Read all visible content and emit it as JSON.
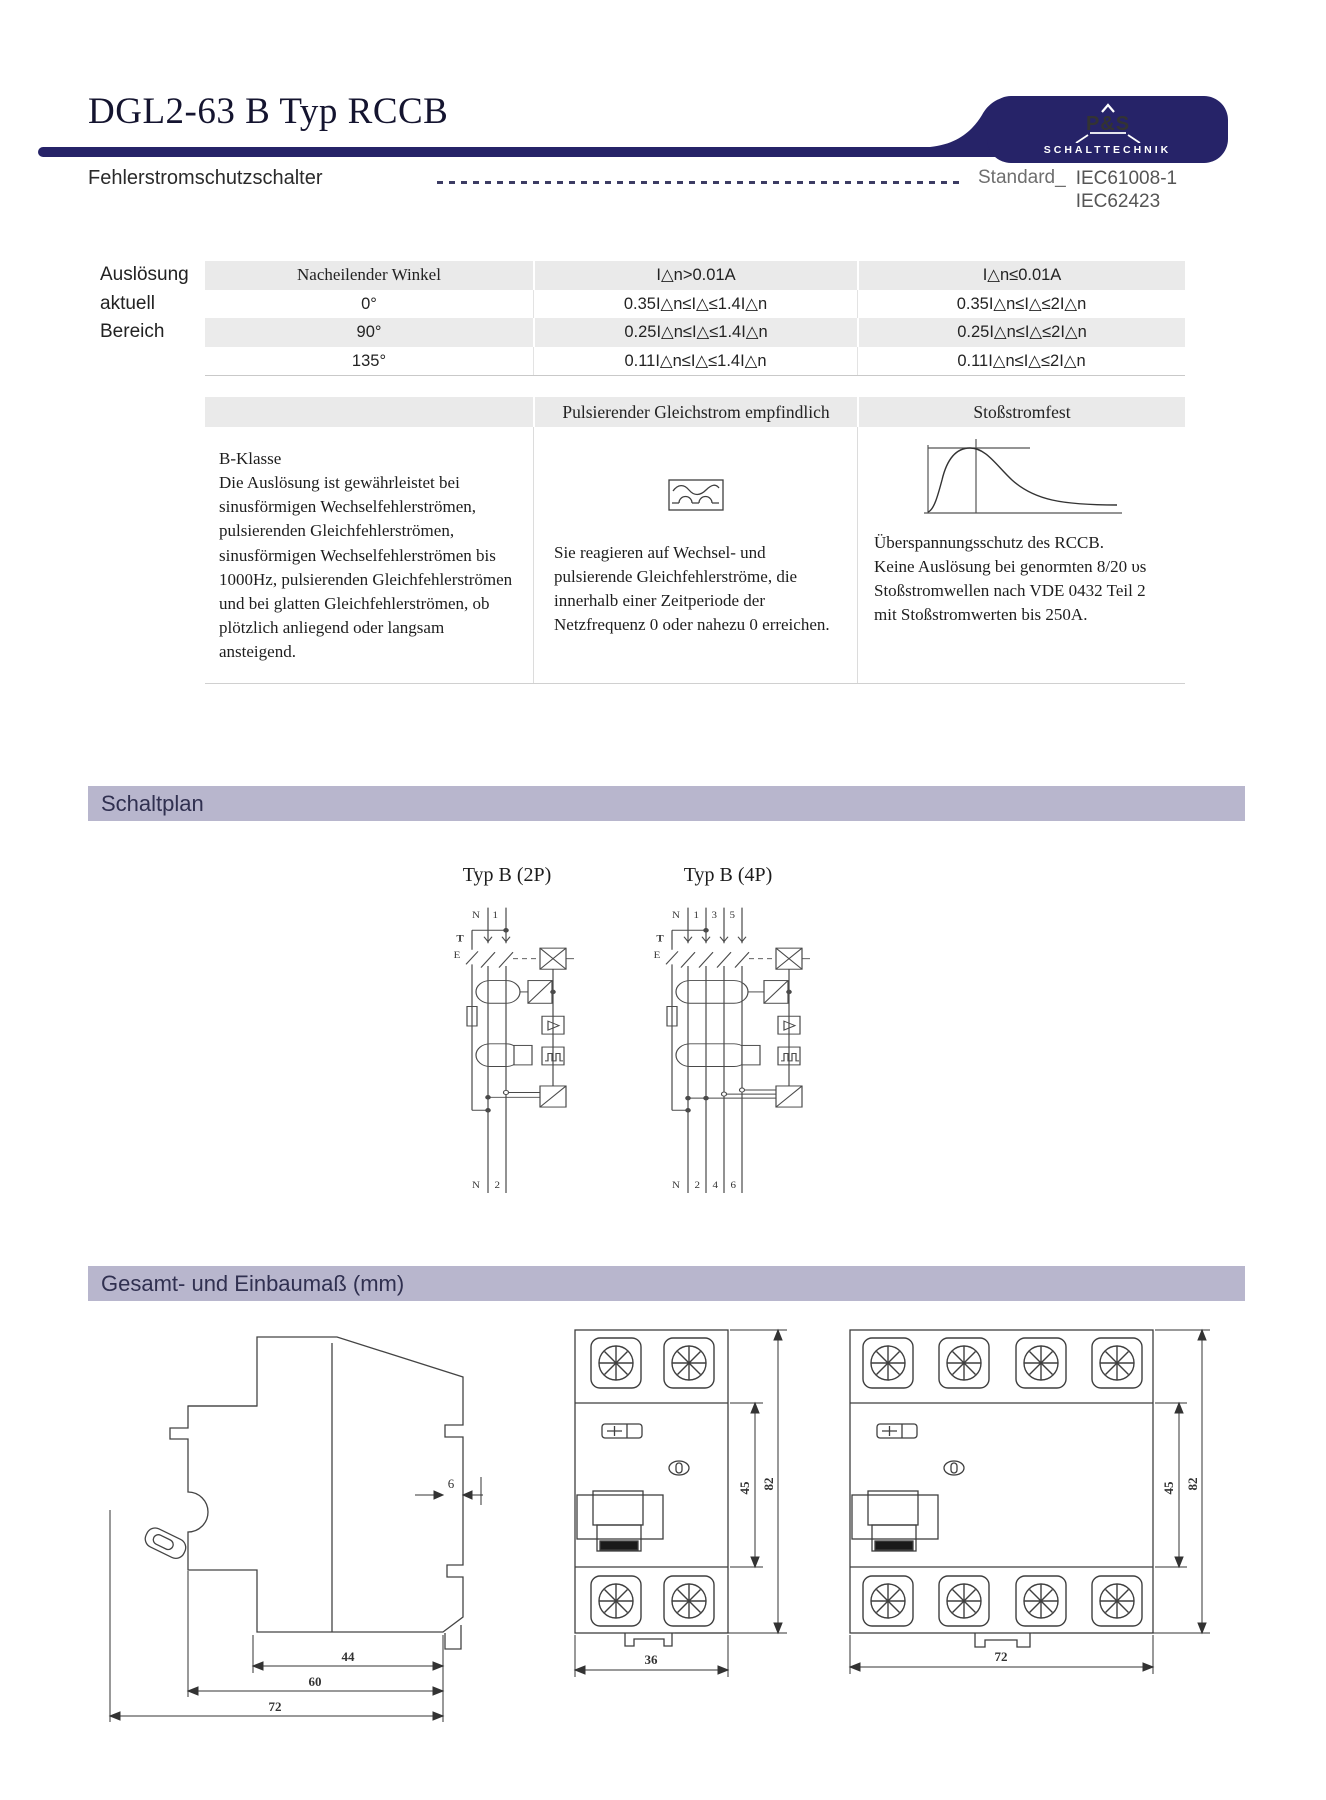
{
  "header": {
    "title": "DGL2-63 B Typ RCCB",
    "subtitle": "Fehlerstromschutzschalter",
    "standard_label": "Standard_",
    "standard_1": "IEC61008-1",
    "standard_2": "IEC62423",
    "logo_name": "P&S",
    "logo_tagline": "SCHALTTECHNIK"
  },
  "trip_table": {
    "side_label": [
      "Auslösung",
      "aktuell",
      "Bereich"
    ],
    "headers": [
      "Nacheilender Winkel",
      "I△n>0.01A",
      "I△n≤0.01A"
    ],
    "rows": [
      [
        "0°",
        "0.35I△n≤I△≤1.4I△n",
        "0.35I△n≤I△≤2I△n"
      ],
      [
        "90°",
        "0.25I△n≤I△≤1.4I△n",
        "0.25I△n≤I△≤2I△n"
      ],
      [
        "135°",
        "0.11I△n≤I△≤1.4I△n",
        "0.11I△n≤I△≤2I△n"
      ]
    ]
  },
  "class_table": {
    "pulse_header": "Pulsierender Gleichstrom empfindlich",
    "surge_header": "Stoßstromfest",
    "b_class_title": "B-Klasse",
    "b_class_body": "Die Auslösung ist gewährleistet bei sinusförmigen Wechselfehlerströmen, pulsierenden Gleichfehlerströmen, sinusförmigen Wechselfehlerströmen bis 1000Hz, pulsierenden Gleichfehlerströmen und bei glatten Gleichfehlerströmen, ob plötzlich anliegend oder langsam ansteigend.",
    "pulse_body": "Sie reagieren auf Wechsel- und pulsierende Gleichfehlerströme, die innerhalb einer Zeitperiode der Netzfrequenz 0 oder nahezu 0 erreichen.",
    "surge_body": "Überspannungsschutz des RCCB.\nKeine Auslösung bei genormten 8/20 υs Stoßstromwellen nach VDE 0432 Teil 2 mit Stoßstromwerten bis 250A."
  },
  "sections": {
    "schaltplan": "Schaltplan",
    "dimensions": "Gesamt- und Einbaumaß (mm)"
  },
  "diagram_2p": {
    "label": "Typ B (2P)",
    "t": "T",
    "e": "E",
    "top": [
      "N",
      "1"
    ],
    "bottom": [
      "N",
      "2"
    ]
  },
  "diagram_4p": {
    "label": "Typ B (4P)",
    "t": "T",
    "e": "E",
    "top": [
      "N",
      "1",
      "3",
      "5"
    ],
    "bottom": [
      "N",
      "2",
      "4",
      "6"
    ]
  },
  "dimensions": {
    "side": {
      "rail": "6",
      "inner": "44",
      "mid": "60",
      "outer": "72"
    },
    "front_2p": {
      "height_inner": "45",
      "height_outer": "82",
      "width": "36"
    },
    "front_4p": {
      "height_inner": "45",
      "height_outer": "82",
      "width": "72"
    }
  },
  "colors": {
    "navy": "#262368",
    "section_bar": "#b8b6cd",
    "table_gray": "#eaeaea"
  }
}
